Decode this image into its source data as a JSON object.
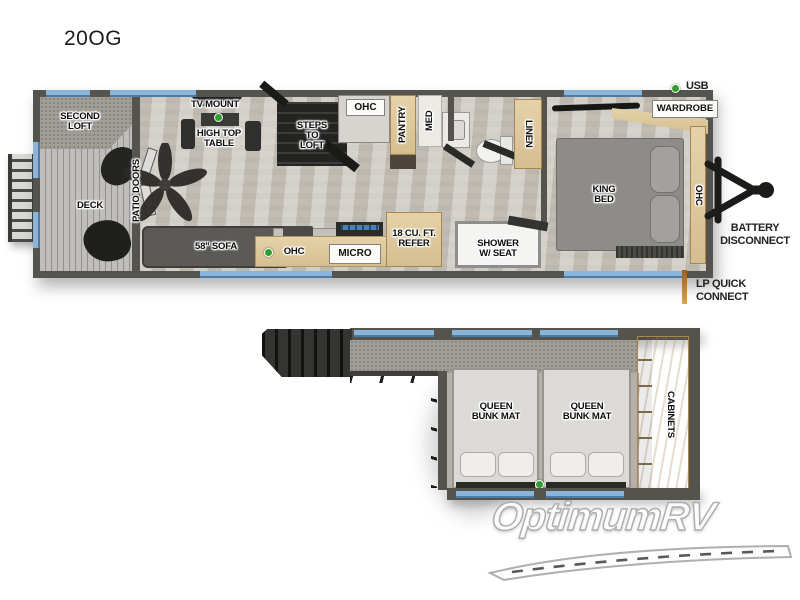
{
  "title": "20OG",
  "watermark": "OptimumRV",
  "colors": {
    "wall": "#55534e",
    "floor": "#ccc7be",
    "cabinet_wood": "#ddc79c",
    "window_blue": "#8ab5d9",
    "indicator_green": "#2f9e2f",
    "lp_orange": "#c8822e"
  },
  "main_floor": {
    "rooms": {
      "second_loft": "SECOND\nLOFT",
      "deck": "DECK",
      "patio_doors": "PATIO DOORS",
      "tv_mount": "TV MOUNT",
      "high_top_table": "HIGH TOP\nTABLE",
      "steps_to_loft": "STEPS\nTO\nLOFT",
      "ohc_overhead": "OHC",
      "pantry": "PANTRY",
      "med": "MED",
      "sofa": "58\" SOFA",
      "ohc_kitchen": "OHC",
      "micro": "MICRO",
      "refrigerator": "18 CU. FT.\nREFER",
      "shower": "SHOWER\nW/ SEAT",
      "linen": "LINEN",
      "king_bed": "KING\nBED",
      "wardrobe": "WARDROBE",
      "ohc_bedroom": "OHC"
    },
    "callouts": {
      "usb": "USB",
      "battery_disconnect": "BATTERY\nDISCONNECT",
      "lp_quick_connect": "LP QUICK\nCONNECT"
    }
  },
  "loft_floor": {
    "rooms": {
      "bunk_left": "QUEEN\nBUNK MAT",
      "bunk_right": "QUEEN\nBUNK MAT",
      "cabinets": "CABINETS"
    }
  }
}
